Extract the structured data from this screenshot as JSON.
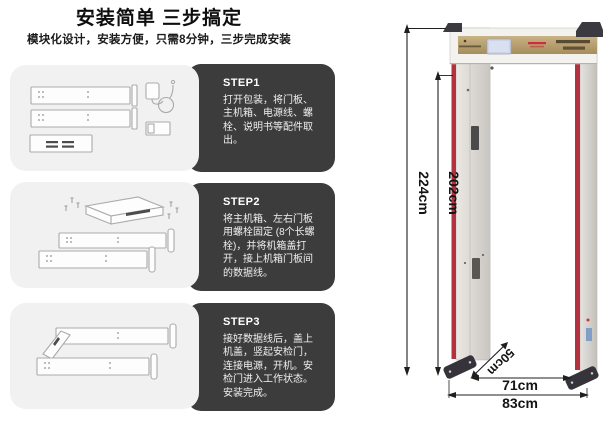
{
  "page": {
    "background": "#ffffff"
  },
  "header": {
    "title": "安装简单 三步搞定",
    "subtitle": "模块化设计，安装方便，只需8分钟，三步完成安装"
  },
  "steps": [
    {
      "label": "STEP1",
      "text": "打开包装，将门板、主机箱、电源线、螺栓、说明书等配件取出。",
      "illustration": "unpacked-door-panels-power-adapter-manual"
    },
    {
      "label": "STEP2",
      "text": "将主机箱、左右门板用螺栓固定 (8个长螺栓)，并将机箱盖打开，接上机箱门板间的数据线。",
      "illustration": "host-box-bolted-to-left-right-panels"
    },
    {
      "label": "STEP3",
      "text": "接好数据线后，盖上机盖，竖起安检门，连接电源，开机。安检门进入工作状态。安装完成。",
      "illustration": "cover-closed-gate-ready-to-stand-up"
    }
  ],
  "diagram": {
    "dimensions": {
      "outer_height": "224cm",
      "inner_height": "202cm",
      "depth": "50cm",
      "inner_width": "71cm",
      "outer_width": "83cm"
    },
    "colors": {
      "led_strip": "#b43140",
      "header_panel_gold": "#b59c6e",
      "lcd_screen": "#ccd4e6",
      "pillar_gray": "#d8d5d1",
      "caps_and_feet": "#3b3a40",
      "card_dark": "#3d3c3c",
      "card_light": "#f1f1f1"
    }
  }
}
